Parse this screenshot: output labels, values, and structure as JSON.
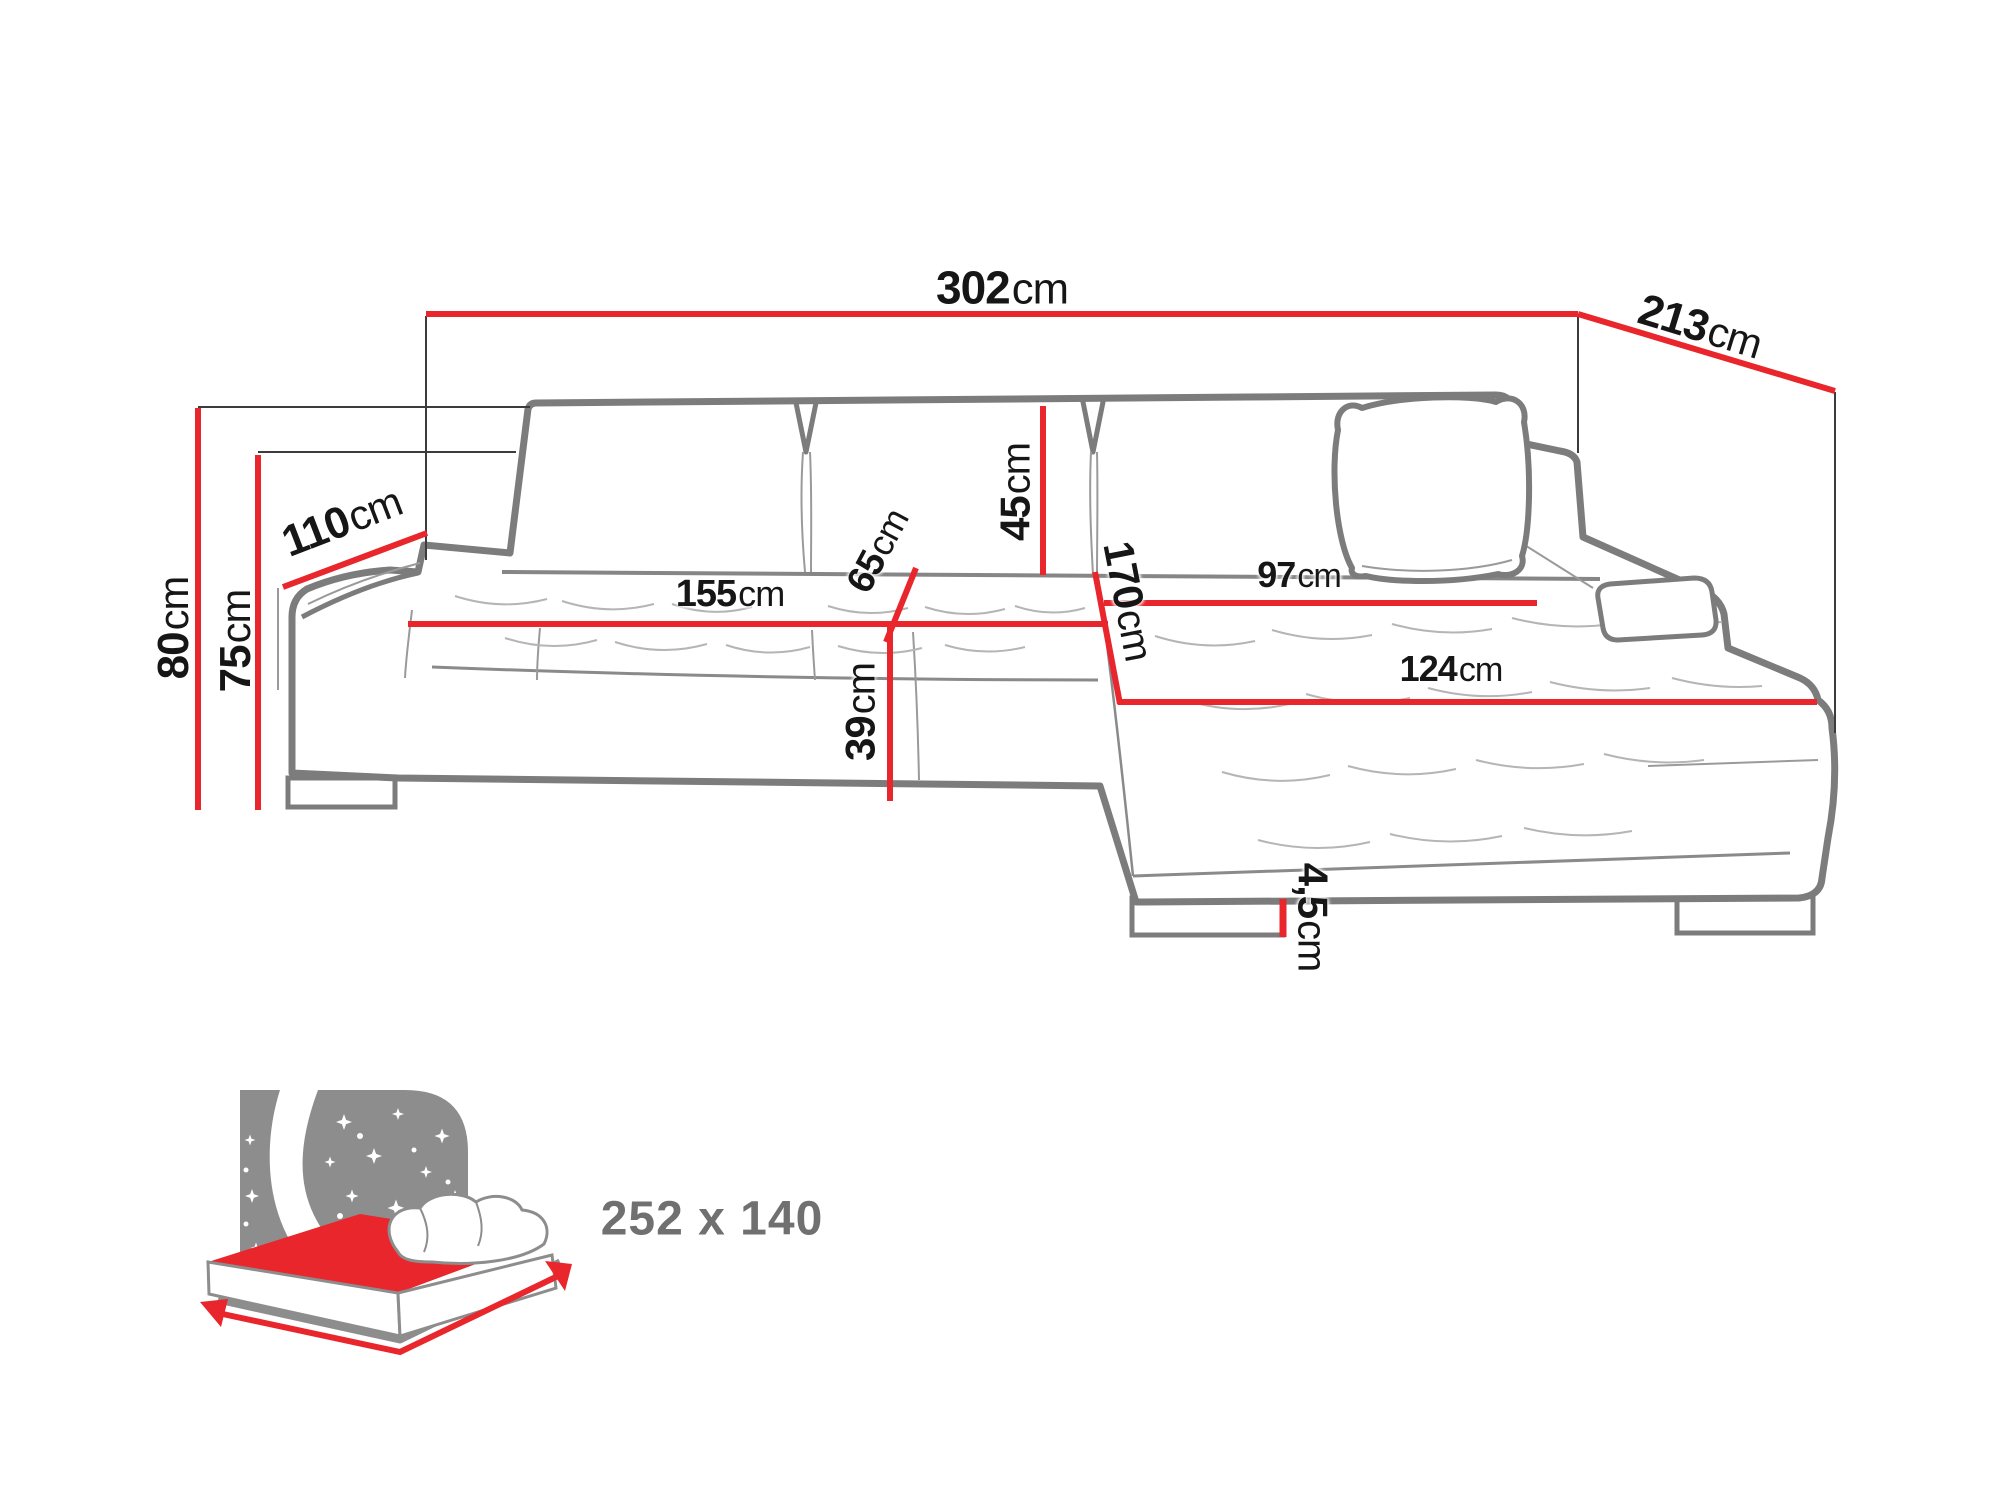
{
  "meta": {
    "type": "product-dimension-diagram",
    "subject": "corner sofa with chaise, sleeping function"
  },
  "colors": {
    "dimension_red": "#e8262b",
    "outline_gray": "#7c7c7c",
    "detail_gray": "#9a9a9a",
    "extension_dark": "#3c3c3c",
    "label_black": "#161616",
    "icon_gray": "#8d8d8d",
    "sleep_text_gray": "#707070",
    "background": "#ffffff"
  },
  "dimensions": {
    "total_width": {
      "value": "302",
      "unit": "cm"
    },
    "total_depth": {
      "value": "213",
      "unit": "cm"
    },
    "side_depth": {
      "value": "110",
      "unit": "cm"
    },
    "total_height": {
      "value": "80",
      "unit": "cm"
    },
    "backrest_height": {
      "value": "75",
      "unit": "cm"
    },
    "seat_width": {
      "value": "155",
      "unit": "cm"
    },
    "seat_depth": {
      "value": "65",
      "unit": "cm"
    },
    "back_cushion_height": {
      "value": "45",
      "unit": "cm"
    },
    "chaise_length": {
      "value": "170",
      "unit": "cm"
    },
    "chaise_width_back": {
      "value": "97",
      "unit": "cm"
    },
    "chaise_width_front": {
      "value": "124",
      "unit": "cm"
    },
    "seat_height": {
      "value": "39",
      "unit": "cm"
    },
    "leg_height": {
      "value": "4,5",
      "unit": "cm"
    }
  },
  "sleeping_area": {
    "label": "252 x 140",
    "icon": "bed-with-night-sky-icon"
  }
}
